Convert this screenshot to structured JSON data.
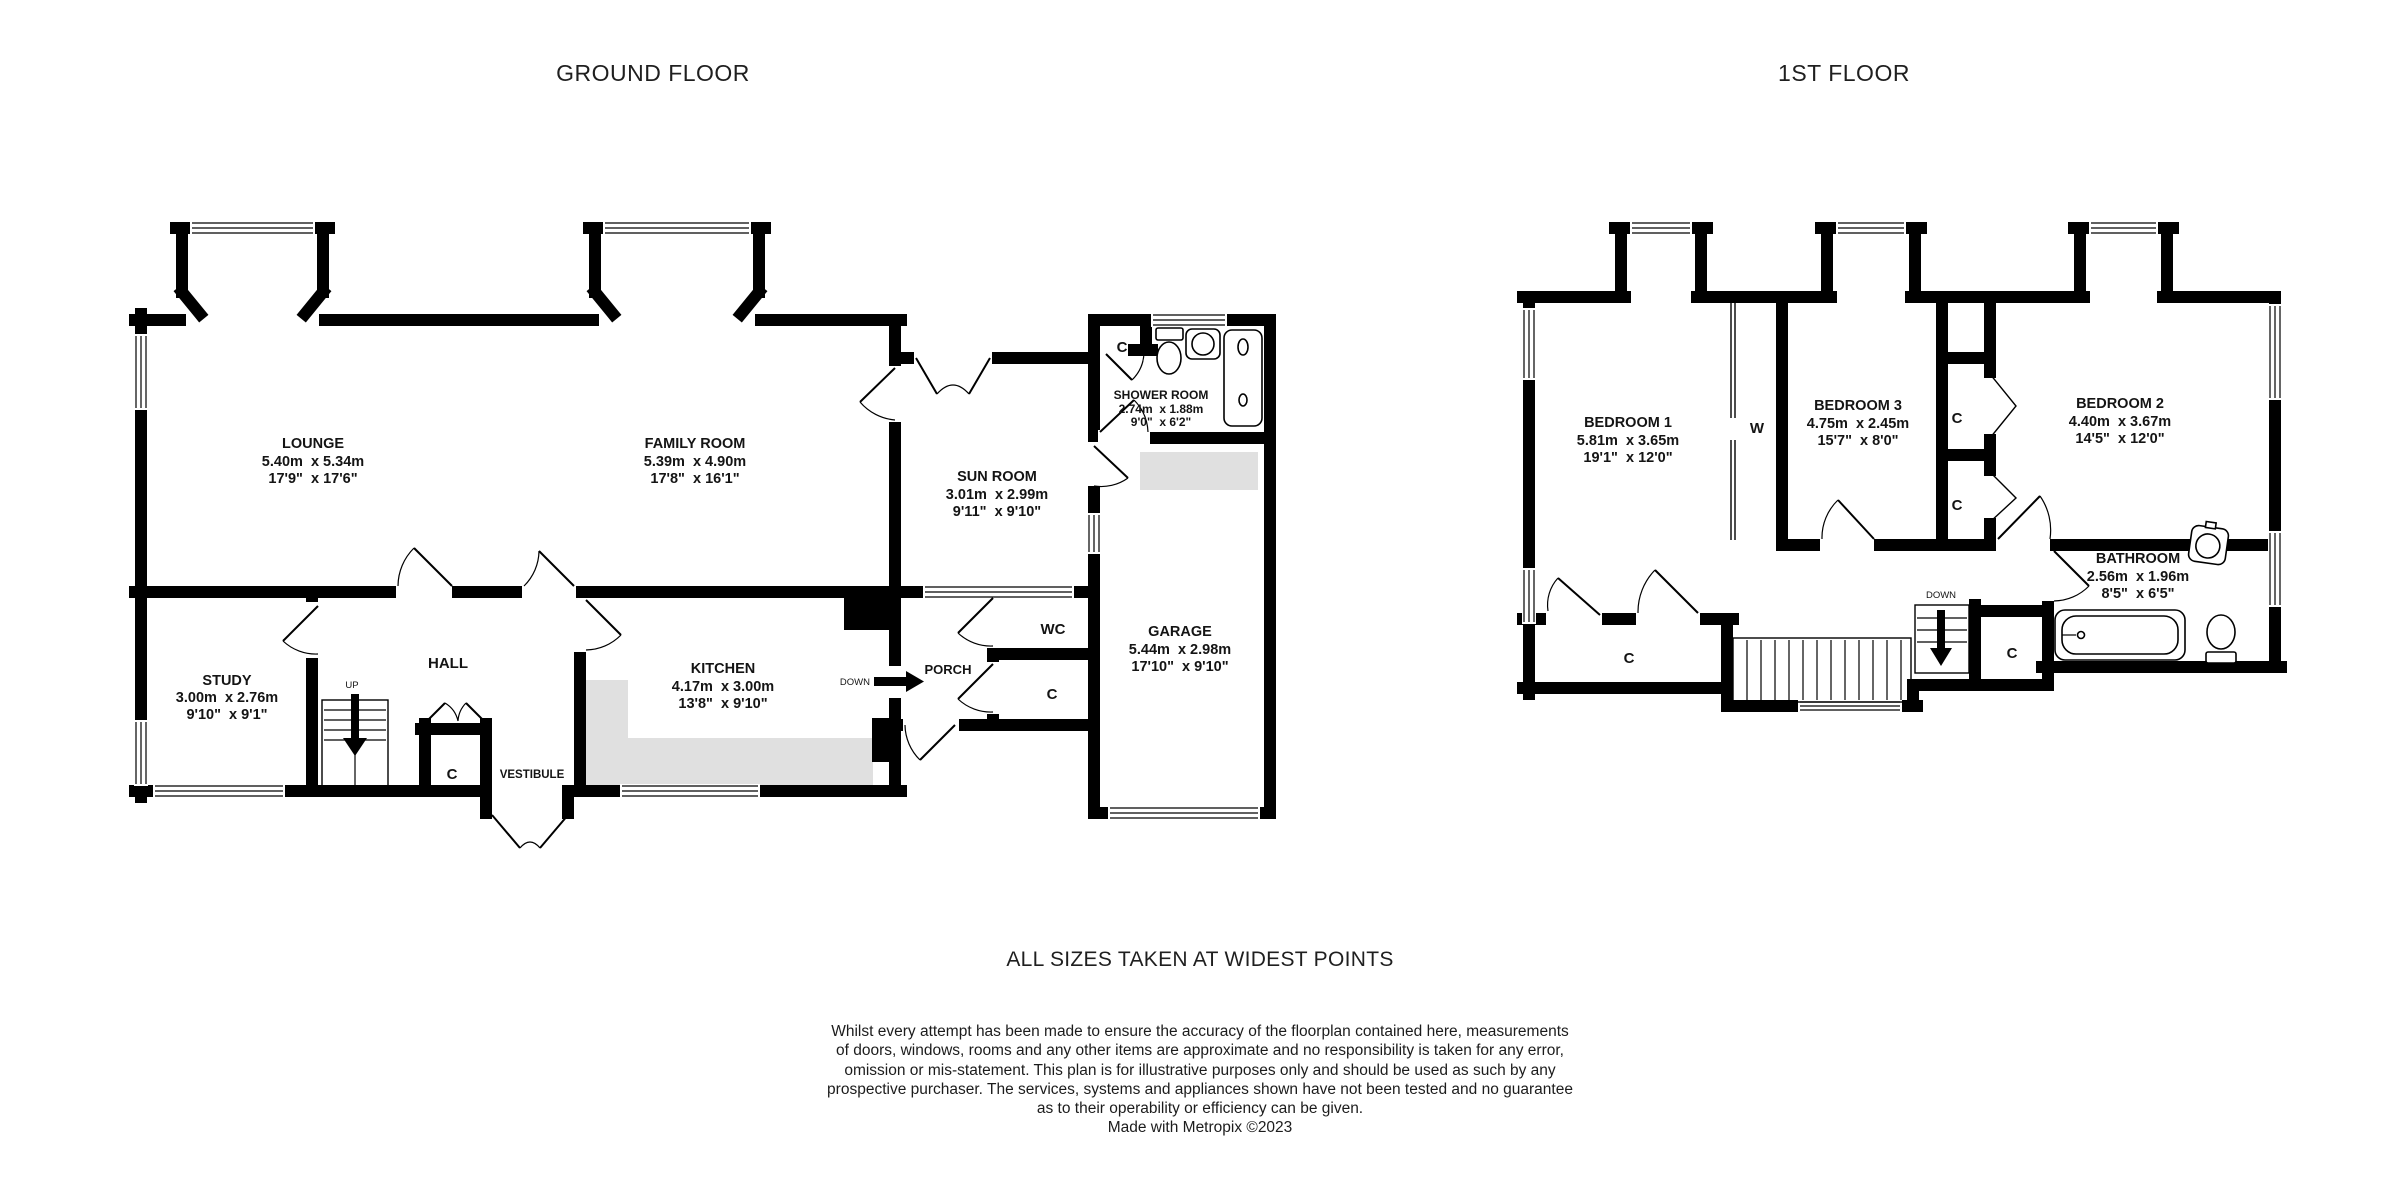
{
  "titles": {
    "ground_floor": "GROUND FLOOR",
    "first_floor": "1ST FLOOR"
  },
  "notes": {
    "sizes": "ALL SIZES TAKEN AT WIDEST POINTS"
  },
  "disclaimer": {
    "line1": "Whilst every attempt has been made to ensure the accuracy of the floorplan contained here, measurements",
    "line2": "of doors, windows, rooms and any other items are approximate and no responsibility is taken for any error,",
    "line3": "omission or mis-statement. This plan is for illustrative purposes only and should be used as such by any",
    "line4": "prospective purchaser. The services, systems and appliances shown have not been tested and no guarantee",
    "line5": "as to their operability or efficiency can be given.",
    "line6": "Made with Metropix ©2023"
  },
  "ground_floor": {
    "rooms": {
      "lounge": {
        "name": "LOUNGE",
        "metric": "5.40m  x 5.34m",
        "imperial": "17'9\"  x 17'6\""
      },
      "family_room": {
        "name": "FAMILY ROOM",
        "metric": "5.39m  x 4.90m",
        "imperial": "17'8\"  x 16'1\""
      },
      "sun_room": {
        "name": "SUN ROOM",
        "metric": "3.01m  x 2.99m",
        "imperial": "9'11\"  x 9'10\""
      },
      "shower_room": {
        "name": "SHOWER ROOM",
        "metric": "2.74m  x 1.88m",
        "imperial": "9'0\"  x 6'2\""
      },
      "kitchen": {
        "name": "KITCHEN",
        "metric": "4.17m  x 3.00m",
        "imperial": "13'8\"  x 9'10\""
      },
      "study": {
        "name": "STUDY",
        "metric": "3.00m  x 2.76m",
        "imperial": "9'10\"  x 9'1\""
      },
      "garage": {
        "name": "GARAGE",
        "metric": "5.44m  x 2.98m",
        "imperial": "17'10\"  x 9'10\""
      },
      "hall": {
        "name": "HALL"
      },
      "wc": {
        "name": "WC"
      },
      "porch": {
        "name": "PORCH"
      },
      "vestibule": {
        "name": "VESTIBULE"
      }
    },
    "markers": {
      "up": "UP",
      "down": "DOWN",
      "closet": "C"
    }
  },
  "first_floor": {
    "rooms": {
      "bedroom1": {
        "name": "BEDROOM 1",
        "metric": "5.81m  x 3.65m",
        "imperial": "19'1\"  x 12'0\""
      },
      "bedroom3": {
        "name": "BEDROOM 3",
        "metric": "4.75m  x 2.45m",
        "imperial": "15'7\"  x 8'0\""
      },
      "bedroom2": {
        "name": "BEDROOM 2",
        "metric": "4.40m  x 3.67m",
        "imperial": "14'5\"  x 12'0\""
      },
      "bathroom": {
        "name": "BATHROOM",
        "metric": "2.56m  x 1.96m",
        "imperial": "8'5\"  x 6'5\""
      }
    },
    "markers": {
      "down": "DOWN",
      "closet": "C",
      "wardrobe": "W"
    }
  },
  "colors": {
    "wall": "#000000",
    "shading": "#e0e0e0",
    "background": "#ffffff"
  }
}
